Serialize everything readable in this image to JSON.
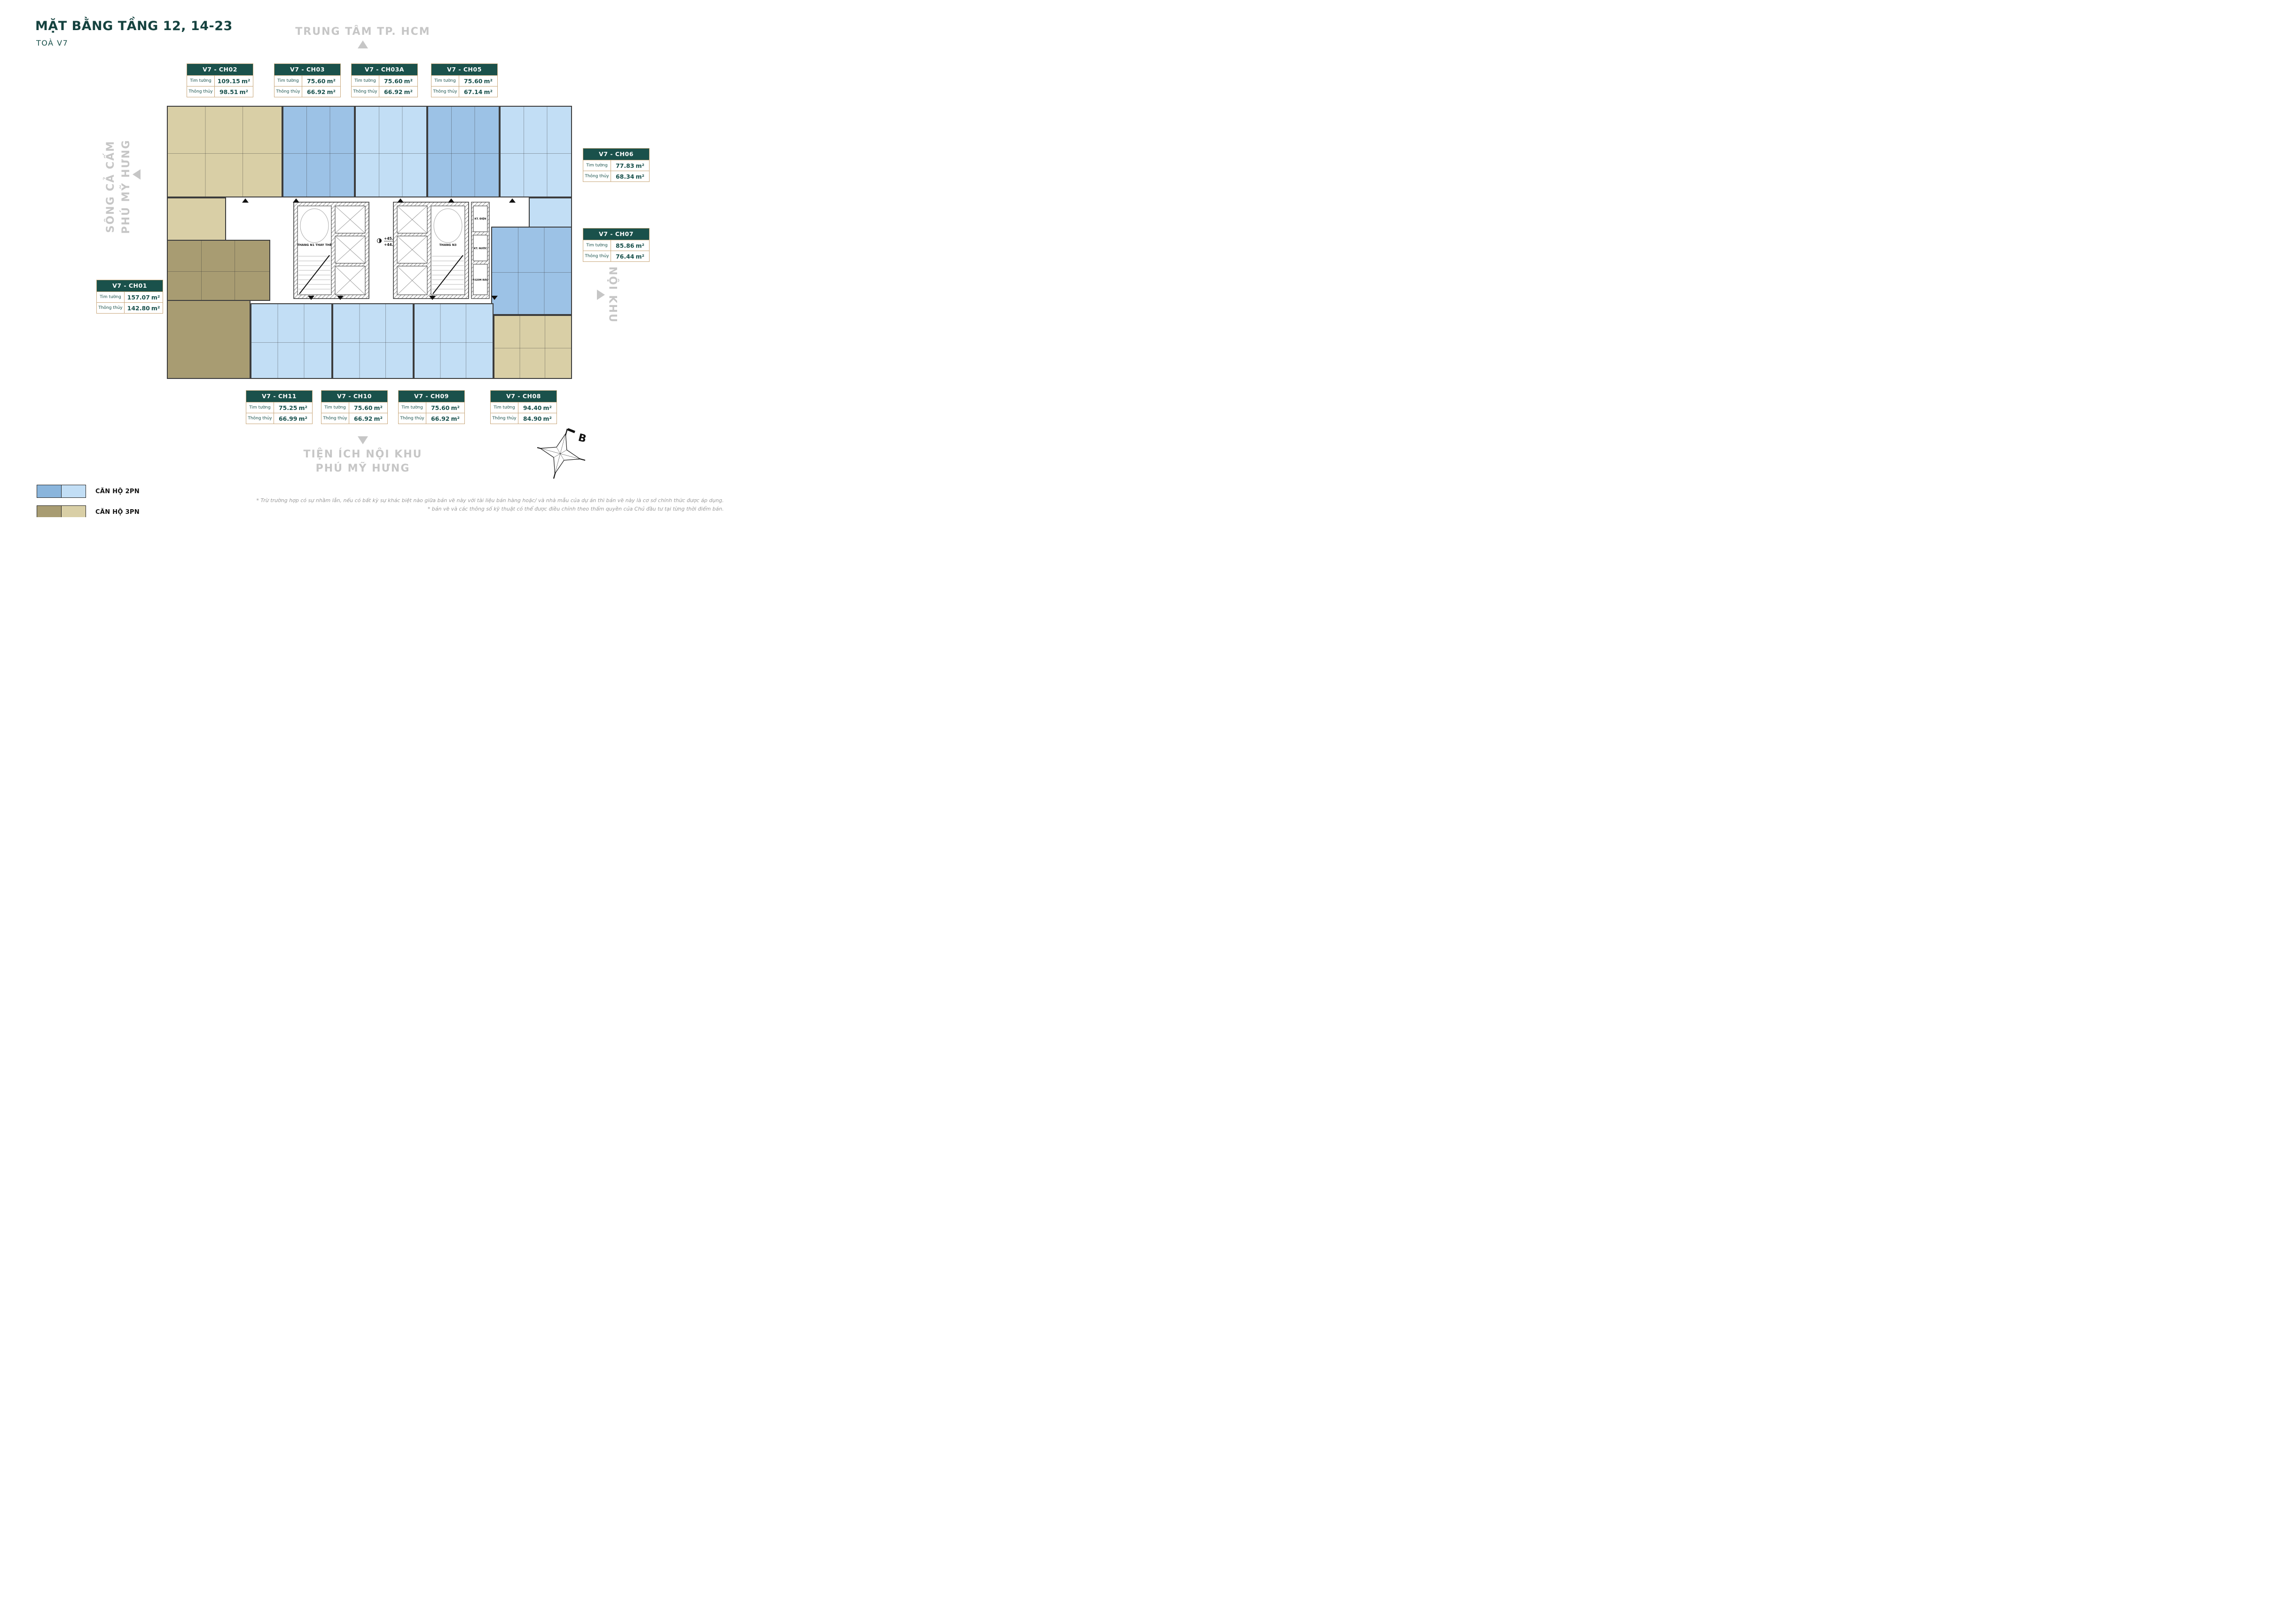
{
  "page": {
    "title": "MẶT BẰNG TẦNG 12, 14-23",
    "subtitle": "TOÀ V7"
  },
  "directions": {
    "top": "TRUNG TÂM TP. HCM",
    "left": [
      "SÔNG CẢ CẤM",
      "PHÚ MỸ HƯNG"
    ],
    "right": "NỘI KHU",
    "bottom": [
      "TIỆN ÍCH NỘI KHU",
      "PHÚ MỸ HƯNG"
    ]
  },
  "area_labels": {
    "tim_tuong": "Tim tường",
    "thong_thuy": "Thông thủy",
    "unit": "m²"
  },
  "units": {
    "ch01": {
      "name": "V7 - CH01",
      "tim_tuong": "157.07",
      "thong_thuy": "142.80",
      "type": "3PN",
      "fill": "tan_dark"
    },
    "ch02": {
      "name": "V7 - CH02",
      "tim_tuong": "109.15",
      "thong_thuy": "98.51",
      "type": "3PN",
      "fill": "tan_light"
    },
    "ch03": {
      "name": "V7 - CH03",
      "tim_tuong": "75.60",
      "thong_thuy": "66.92",
      "type": "2PN",
      "fill": "blue_medium"
    },
    "ch03a": {
      "name": "V7 - CH03A",
      "tim_tuong": "75.60",
      "thong_thuy": "66.92",
      "type": "2PN",
      "fill": "blue_light"
    },
    "ch05": {
      "name": "V7 - CH05",
      "tim_tuong": "75.60",
      "thong_thuy": "67.14",
      "type": "2PN",
      "fill": "blue_medium"
    },
    "ch06": {
      "name": "V7 - CH06",
      "tim_tuong": "77.83",
      "thong_thuy": "68.34",
      "type": "2PN",
      "fill": "blue_light"
    },
    "ch07": {
      "name": "V7 - CH07",
      "tim_tuong": "85.86",
      "thong_thuy": "76.44",
      "type": "2PN",
      "fill": "blue_medium"
    },
    "ch08": {
      "name": "V7 - CH08",
      "tim_tuong": "94.40",
      "thong_thuy": "84.90",
      "type": "3PN",
      "fill": "tan_light"
    },
    "ch09": {
      "name": "V7 - CH09",
      "tim_tuong": "75.60",
      "thong_thuy": "66.92",
      "type": "2PN",
      "fill": "blue_light"
    },
    "ch10": {
      "name": "V7 - CH10",
      "tim_tuong": "75.60",
      "thong_thuy": "66.92",
      "type": "2PN",
      "fill": "blue_light"
    },
    "ch11": {
      "name": "V7 - CH11",
      "tim_tuong": "75.25",
      "thong_thuy": "66.99",
      "type": "2PN",
      "fill": "blue_light"
    }
  },
  "core": {
    "stair_left": "THANG N1 THAY THẾ",
    "stair_right": "THANG N3",
    "levels": [
      "+45.000",
      "+44.950"
    ],
    "tech_rooms": [
      "KT. ĐIỆN",
      "KT. NƯỚC",
      "P.GOM RÁC"
    ]
  },
  "legend": [
    {
      "label": "CĂN HỘ 2PN",
      "colors": [
        "#8ab5dc",
        "#c2def5"
      ]
    },
    {
      "label": "CĂN HỘ 3PN",
      "colors": [
        "#a89c72",
        "#d9cfa6"
      ]
    }
  ],
  "compass": {
    "north_label": "B"
  },
  "footnotes": [
    "* Trừ trường hợp có sự nhầm lẫn, nếu có bất kỳ sự khác biệt nào giữa bản vẽ này với tài liệu bán hàng hoặc/ và nhà mẫu của dự án thì bản vẽ này là cơ sở chính thức được áp dụng.",
    "* bản vẽ và các thông số kỹ thuật có thể được điều chỉnh theo thẩm quyền của Chủ đầu tư tại từng thời điểm bán."
  ],
  "colors": {
    "teal": "#1a514b",
    "gold_border": "#c9a87c",
    "wall": "#3c3c3c",
    "direction_gray": "#c6c6c6",
    "blue_medium": "#9cc2e6",
    "blue_light": "#c2def5",
    "tan_dark": "#a89c72",
    "tan_light": "#d9cfa6"
  }
}
